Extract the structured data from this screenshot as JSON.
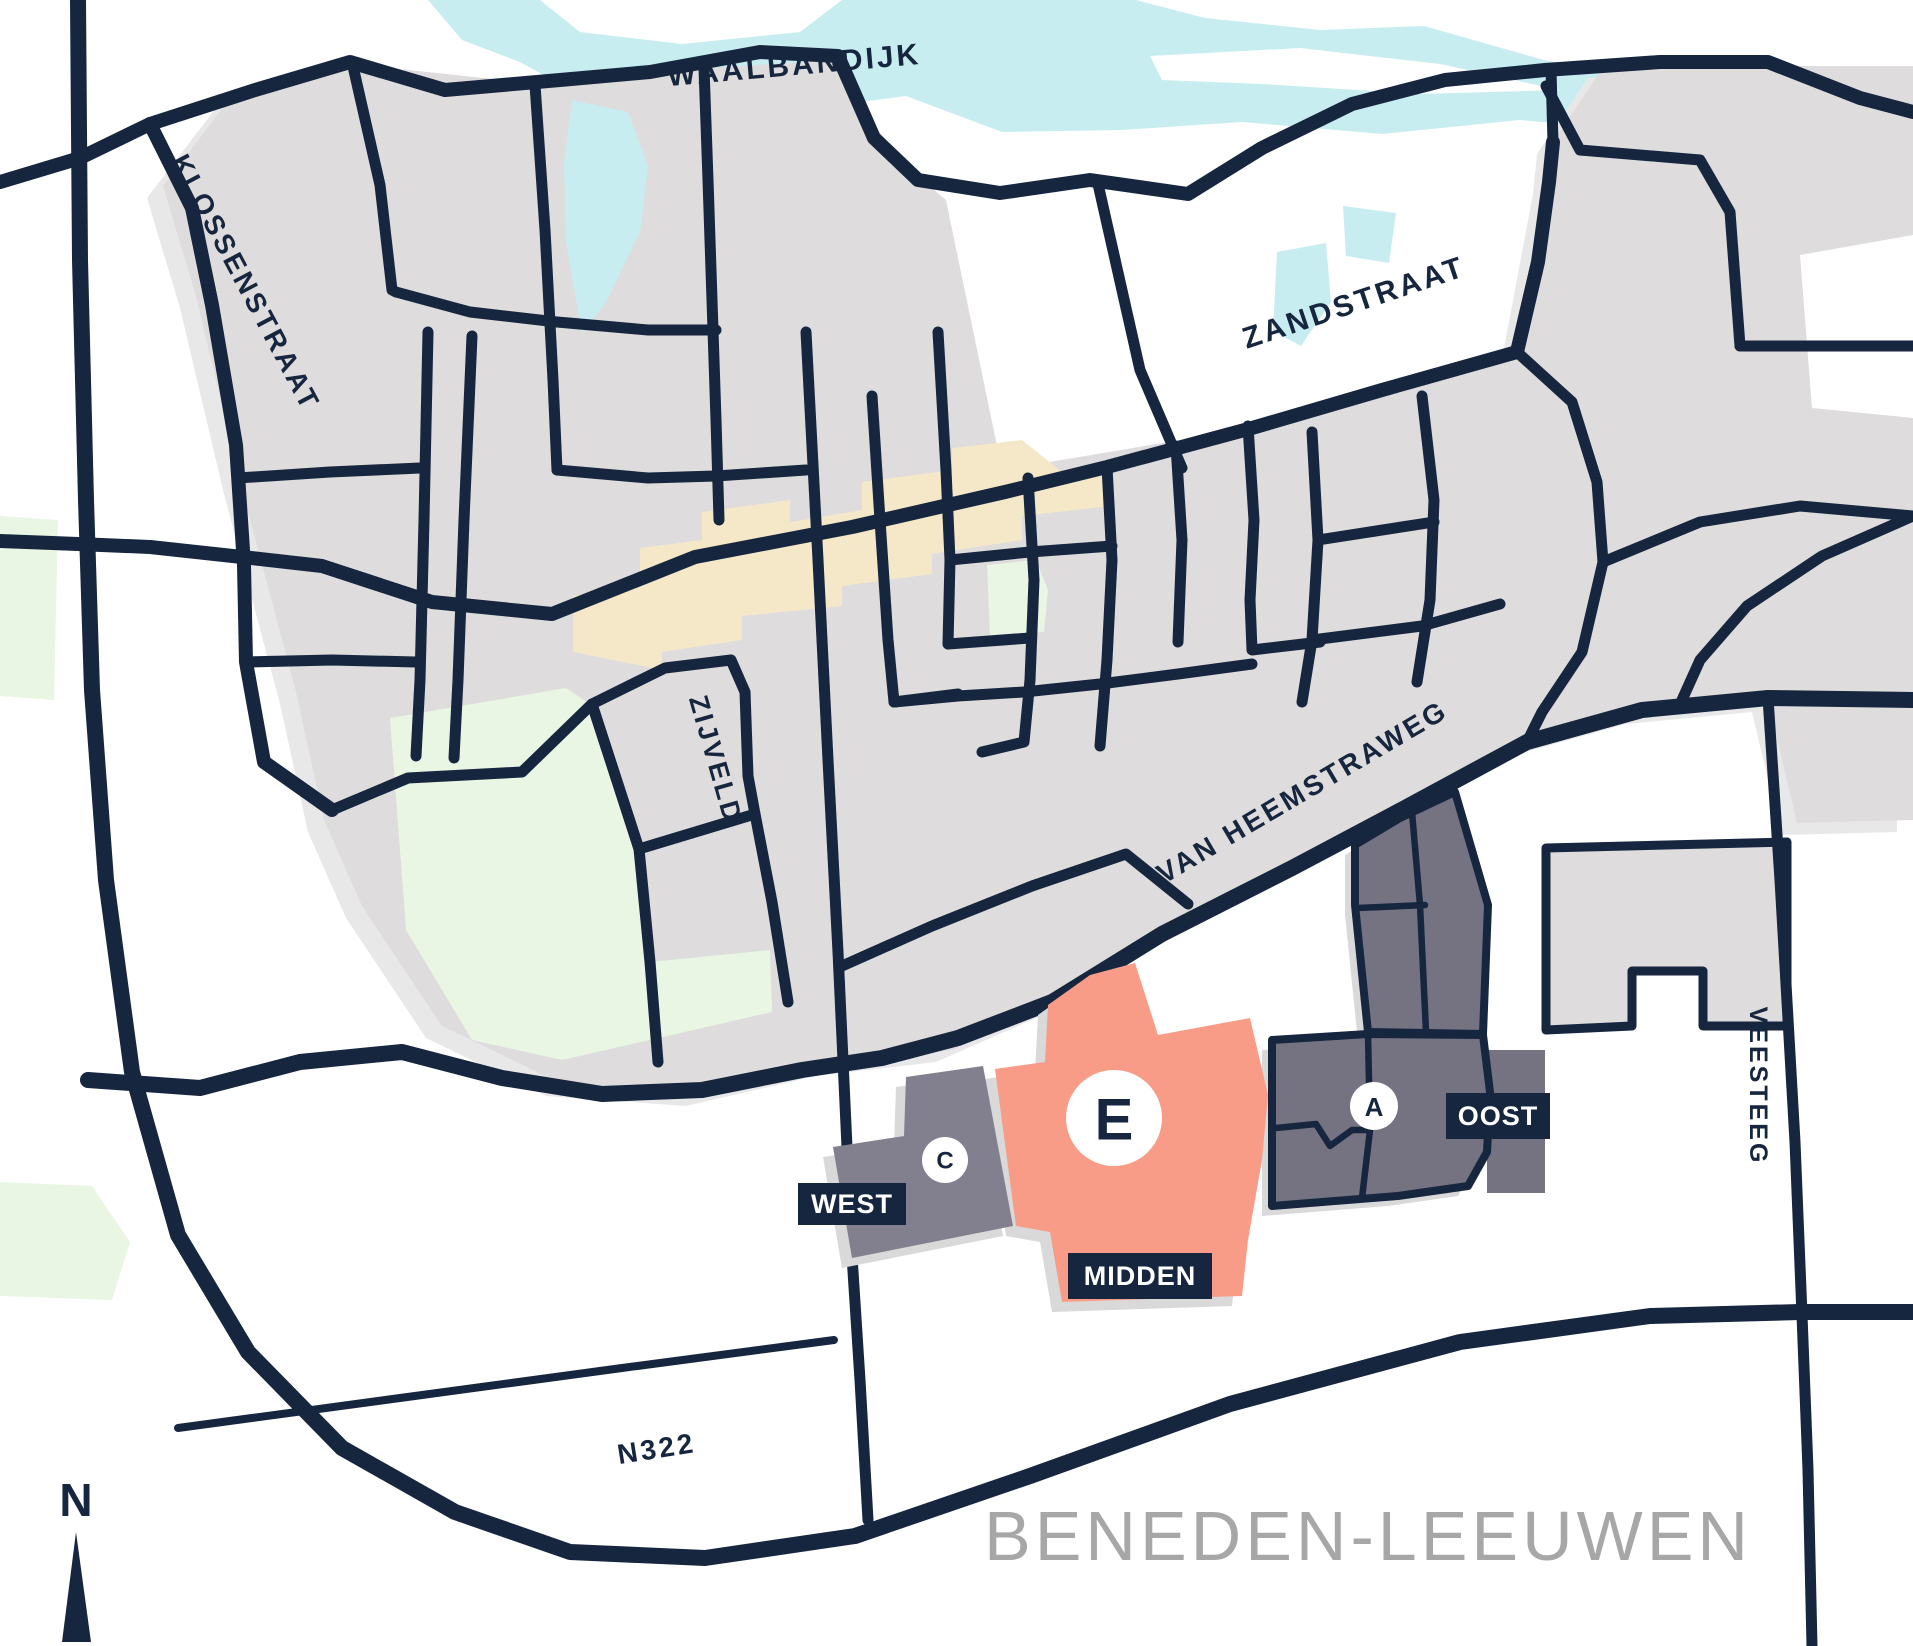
{
  "place": {
    "name": "BENEDEN-LEEUWEN"
  },
  "compass": {
    "north_label": "N"
  },
  "streets": {
    "waalbandijk": "WAALBANDIJK",
    "klossenstraat": "KLOSSENSTRAAT",
    "zandstraat": "ZANDSTRAAT",
    "zijveld": "ZIJVELD",
    "van_heemstraweg": "VAN HEEMSTRAWEG",
    "veesteeg": "VEESTEEG",
    "n322": "N322"
  },
  "zones": {
    "west": {
      "label": "WEST",
      "marker": "C"
    },
    "midden": {
      "label": "MIDDEN",
      "marker": "E"
    },
    "oost": {
      "label": "OOST",
      "marker": "A"
    }
  },
  "colors": {
    "paper": "#ffffff",
    "water": "#c8edf1",
    "urban": "#dedcdc",
    "urban_halo": "#e9e8e8",
    "road": "#16263e",
    "beige": "#f4e8c9",
    "green": "#e9f6e3",
    "zone_west": "#82808f",
    "zone_oost": "#757282",
    "zone_midden": "#f89c87",
    "label_box": "#16263e",
    "label_text": "#ffffff",
    "marker_bg": "#ffffff",
    "marker_text": "#16263e",
    "place_text": "#a7a7a7",
    "shadow": "#dad9d9"
  }
}
